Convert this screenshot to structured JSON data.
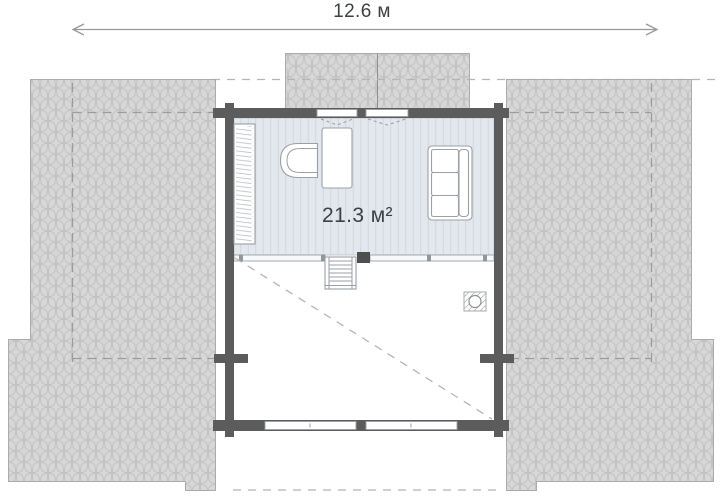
{
  "plan": {
    "dimension": {
      "label": "12.6 м",
      "value_m": 12.6
    },
    "room": {
      "area_label": "21.3 м²",
      "area_value_m2": 21.3,
      "furniture_icons": [
        "wardrobe-icon",
        "desk-icon",
        "armchair-icon",
        "sofa-icon"
      ],
      "feature_icons": [
        "staircase-icon",
        "railing-icon",
        "chimney-icon",
        "void-opening-diagonal"
      ]
    },
    "roof_icons": [
      "left-roof-slope",
      "right-roof-slope",
      "dormer-roof"
    ]
  },
  "colors": {
    "roof_fill": "#d7d7d7",
    "roof_scale": "#c3c3c3",
    "roof_outline": "#ababab",
    "wall": "#5c5c5c",
    "floor_fill": "#e3e8ee",
    "floor_stripe": "#d0d7de",
    "furniture_outline": "#9aa0a6",
    "dash": "#9c9c9c",
    "dash_light": "#b5b5b5",
    "dim_line": "#999999",
    "text": "#3e4144"
  }
}
